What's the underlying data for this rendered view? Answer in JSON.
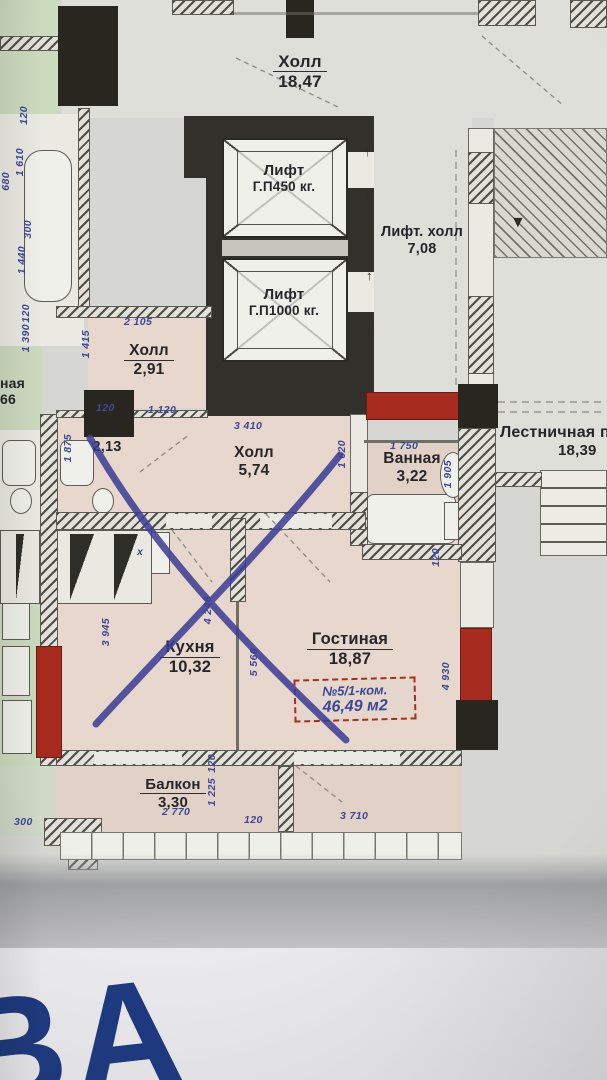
{
  "plan": {
    "watermark": "ВА",
    "stamp": {
      "line1": "№5/1-ком.",
      "line2": "46,49 м2"
    },
    "symbols": {
      "arrow_up": "↑",
      "arrow_down": "↓",
      "arrow_stairs": "▼",
      "sink_mark": "x"
    },
    "rooms": {
      "hall_top": {
        "name": "Холл",
        "area": "18,47"
      },
      "lift_small": {
        "name": "Лифт",
        "capacity": "Г.П450 кг."
      },
      "lift_big": {
        "name": "Лифт",
        "capacity": "Г.П1000 кг."
      },
      "lift_hall": {
        "name": "Лифт. холл",
        "area": "7,08"
      },
      "hall_entry": {
        "name": "Холл",
        "area": "2,91"
      },
      "wc": {
        "name": "С/У",
        "area": "2,13"
      },
      "hall_inner": {
        "name": "Холл",
        "area": "5,74"
      },
      "bathroom": {
        "name": "Ванная",
        "area": "3,22"
      },
      "stair_landing": {
        "name": "Лестничная п",
        "area": "18,39"
      },
      "kitchen": {
        "name": "Кухня",
        "area": "10,32"
      },
      "living": {
        "name": "Гостиная",
        "area": "18,87"
      },
      "balcony": {
        "name": "Балкон",
        "area": "3,30"
      },
      "neighbor_room": {
        "name_fragment": "ная",
        "area_fragment": "66"
      }
    },
    "dims": [
      {
        "t": "2 105"
      },
      {
        "t": "1 415"
      },
      {
        "t": "120"
      },
      {
        "t": "1 120"
      },
      {
        "t": "3 410"
      },
      {
        "t": "1 875"
      },
      {
        "t": "1 620"
      },
      {
        "t": "1 750"
      },
      {
        "t": "1 905"
      },
      {
        "t": "120"
      },
      {
        "t": "3 945"
      },
      {
        "t": "4 246"
      },
      {
        "t": "5 560"
      },
      {
        "t": "4 930"
      },
      {
        "t": "120"
      },
      {
        "t": "1 225"
      },
      {
        "t": "120"
      },
      {
        "t": "2 770"
      },
      {
        "t": "3 710"
      },
      {
        "t": "300"
      },
      {
        "t": "120"
      },
      {
        "t": "1 610"
      },
      {
        "t": "680"
      },
      {
        "t": "300"
      },
      {
        "t": "1 440"
      },
      {
        "t": "120"
      },
      {
        "t": "1 390"
      }
    ],
    "colors": {
      "wall_red": "#a62a1e",
      "ink_blue": "#3d4899",
      "cross_blue": "#3a3d95",
      "watermark_blue": "#1d3a82"
    }
  }
}
